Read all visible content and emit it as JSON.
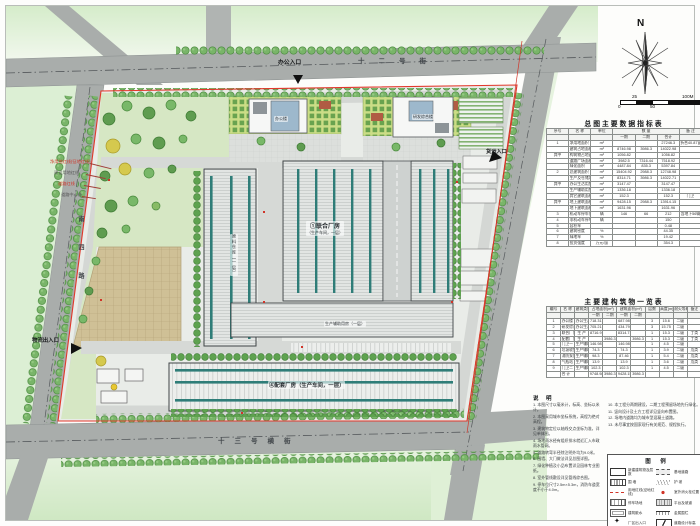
{
  "plan": {
    "entrances": {
      "office": "办公入口",
      "freight": "货运入口",
      "logistics": "物流出入口"
    },
    "streets": {
      "top": "十二号街",
      "bottom": "十三号横街",
      "left": "南四路"
    },
    "boundary_labels": [
      "净用地红线(征地红线)",
      "建设用地红线",
      "道路红线",
      "道路中心线"
    ],
    "buildings": {
      "union_title": "①联合厂房",
      "union_sub": "（生产车间，一层）",
      "support_label": "④配套厂房（生产车间，一层）",
      "warehouse": "原料仓库（一层）",
      "aux": "生产辅助用房（一层）",
      "office1": "办公楼",
      "office2": "研发综合楼"
    }
  },
  "compass": {
    "north_label": "N"
  },
  "scalebar": {
    "ticks_top": [
      "25",
      "100M"
    ],
    "ticks_bottom": [
      "0",
      "50"
    ]
  },
  "table1": {
    "title": "总图主要数据指标表",
    "head": [
      [
        "序号",
        "名  称",
        "单位",
        "数  量|3",
        "备  注"
      ],
      [
        "",
        "",
        "",
        "一期",
        "二期",
        "合计",
        ""
      ]
    ],
    "rows": [
      [
        "1",
        "净用地面积",
        "m²",
        "",
        "",
        "27246.3",
        "折合40.87亩"
      ],
      [
        "",
        "建筑占地面积",
        "m²",
        "8746.98",
        "3986.3",
        "14022.98",
        ""
      ],
      [
        "其中",
        "构筑物占地面积",
        "m²",
        "1056.82",
        "",
        "1056.82",
        ""
      ],
      [
        "",
        "道路广场面积",
        "m²",
        "3982.5",
        "7316.44",
        "7518.92",
        ""
      ],
      [
        "",
        "绿化面积",
        "m²",
        "4487.84",
        "835.3",
        "5397.84",
        ""
      ],
      [
        "2",
        "总建筑面积",
        "m²",
        "15404.92",
        "2988.3",
        "12748.98",
        ""
      ],
      [
        "",
        "生产及仓储用房建筑面积",
        "m²",
        "8314.71",
        "3986.3",
        "14022.71",
        ""
      ],
      [
        "其中",
        "办公生活用房建筑面积",
        "m²",
        "3147.47",
        "",
        "3147.47",
        ""
      ],
      [
        "",
        "生产辅助用房建筑面积",
        "m²",
        "1336.18",
        "",
        "1336.18",
        ""
      ],
      [
        "",
        "其它建筑面积",
        "m²",
        "152.3",
        "",
        "152.3",
        "门卫"
      ],
      [
        "其中",
        "地上建筑面积",
        "m²",
        "9428.15",
        "2988.3",
        "13914.15",
        ""
      ],
      [
        "",
        "地下建筑面积",
        "m²",
        "1631.96",
        "",
        "1631.96",
        ""
      ],
      [
        "3",
        "机动车停车位",
        "辆",
        "146",
        "66",
        "212",
        "含地下56辆"
      ],
      [
        "4",
        "非机动车停车位",
        "辆",
        "",
        "",
        "150",
        ""
      ],
      [
        "5",
        "容积率",
        "",
        "",
        "",
        "0.48",
        ""
      ],
      [
        "6",
        "建筑密度",
        "%",
        "",
        "",
        "44.35",
        ""
      ],
      [
        "7",
        "绿地率",
        "%",
        "",
        "",
        "19.42",
        ""
      ],
      [
        "8",
        "投资强度",
        "万元/亩",
        "",
        "",
        "354.3",
        ""
      ]
    ]
  },
  "table2": {
    "title": "主要建构筑物一览表",
    "head": [
      [
        "编号",
        "名  称",
        "建筑类别",
        "占地面积(m²)|2",
        "建筑面积(m²)|2",
        "层数",
        "高度(m)",
        "耐火等级",
        "备注"
      ],
      [
        "",
        "",
        "",
        "一期",
        "二期",
        "一期",
        "二期",
        "",
        "",
        "",
        ""
      ]
    ],
    "rows": [
      [
        "1",
        "办公楼",
        "办公生活",
        "718.31",
        "",
        "687.98",
        "",
        "3",
        "15.6",
        "二级",
        ""
      ],
      [
        "2",
        "研发综合楼",
        "办公生活",
        "705.21",
        "",
        "434.79",
        "",
        "3",
        "15.75",
        "二级",
        ""
      ],
      [
        "3",
        "联合厂房",
        "生  产",
        "8716.9",
        "",
        "8314.71",
        "",
        "1",
        "15.3",
        "二级",
        "丁类"
      ],
      [
        "4",
        "配套厂房",
        "生  产",
        "",
        "3986.3",
        "",
        "3986.3",
        "1",
        "15.3",
        "二级",
        "丁类"
      ],
      [
        "5",
        "门卫一",
        "生产辅助",
        "146.98",
        "",
        "146.98",
        "",
        "1",
        "4.5",
        "二级",
        ""
      ],
      [
        "6",
        "垃圾收集站",
        "生产辅助",
        "74.3",
        "",
        "74.3",
        "",
        "1",
        "3.9",
        "二级",
        "戊类"
      ],
      [
        "7",
        "消防泵房",
        "生产辅助",
        "98.3",
        "",
        "87.46",
        "",
        "1",
        "5.4",
        "二级",
        "戊类"
      ],
      [
        "8",
        "气瓶站",
        "生产辅助",
        "13.9",
        "",
        "13.9",
        "",
        "1",
        "3.6",
        "二级",
        "戊类"
      ],
      [
        "9",
        "门卫二",
        "生产辅助",
        "102.3",
        "",
        "102.3",
        "",
        "1",
        "4.5",
        "二级",
        ""
      ],
      [
        "",
        "合  计",
        "",
        "9748.98",
        "3986.3",
        "9428.15",
        "3986.3",
        "",
        "",
        "",
        ""
      ]
    ]
  },
  "notes": {
    "title": "说  明",
    "col1": [
      "1. 本图尺寸以毫米计，标高、坐标以米计。",
      "2. 本图采用城市坐标系统，高程为绝对高程。",
      "3. 建筑物定位以轴线交点坐标为准，详见单体图。",
      "4. 场地雨水经有组织排水就近汇入市政雨水管网。",
      "5. 道路转弯半径除注明外均为9.0米。",
      "6. 围墙、大门做法详见总图详图。",
      "7. 绿化种植及小品布置详见园林专业图纸。",
      "8. 室外管线敷设详见管线综合图。",
      "9. 停车位尺寸2.5m×5.3m，消防车道宽度不小于4.0m。"
    ],
    "col2": [
      "10. 本工程分两期建设，二期工程预留场地先行绿化。",
      "11. 竖向设计及土方工程详见竖向布置图。",
      "12. 场地内道路均为城市型混凝土道路。",
      "13. 未尽事宜按国家现行有关规范、规程执行。"
    ]
  },
  "legend": {
    "title": "图  例",
    "items": [
      {
        "sym": "building",
        "label": "新建建筑物及层数"
      },
      {
        "sym": "road",
        "label": "基地道路"
      },
      {
        "sym": "wall",
        "label": "围  墙"
      },
      {
        "sym": "slope",
        "label": "护  坡"
      },
      {
        "sym": "redline",
        "label": "用地红线(征地红线)"
      },
      {
        "sym": "hydrant",
        "label": "室外消火栓位置"
      },
      {
        "sym": "stall",
        "label": "停车场地"
      },
      {
        "sym": "ramp",
        "label": "平台及坡道"
      },
      {
        "sym": "apron",
        "label": "建筑散水"
      },
      {
        "sym": "fence",
        "label": "金属围栏"
      },
      {
        "sym": "gate",
        "label": "厂区出入口"
      },
      {
        "sym": "elev",
        "label": "道路设计标高"
      }
    ]
  }
}
